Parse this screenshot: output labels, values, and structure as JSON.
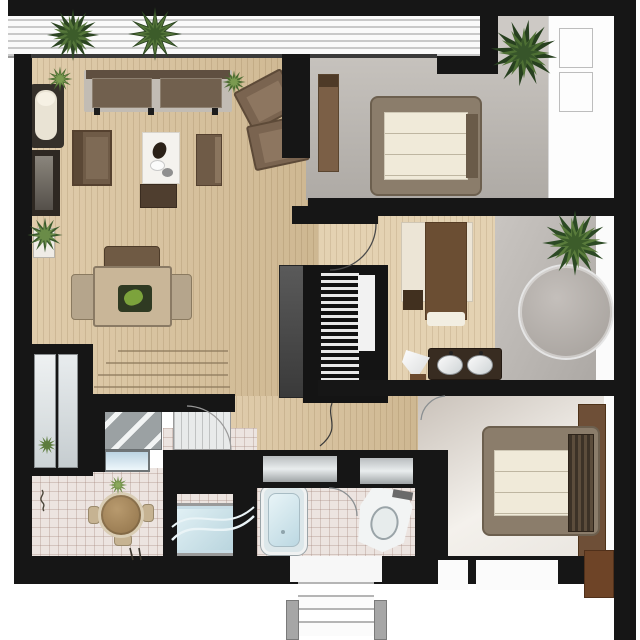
{
  "scene": {
    "type": "apartment floor plan, top-down rendered view",
    "text_labels": []
  },
  "palette": {
    "wall": "#161616",
    "wood_floor": "#d9c199",
    "wood_floor_light": "#e4d2b2",
    "gray_floor": "#b8b3ae",
    "tile_floor": "#ece4e0",
    "mattress": "#f0ead9",
    "bed_frame": "#8b7d6b",
    "sofa_brown": "#6f5b47",
    "dark_wood": "#6e4f37",
    "water_blue": "#cfe3ea",
    "plant_green": "#3c5c2a",
    "balcony_stripe": "#c9c9c9"
  },
  "rooms": [
    {
      "name": "balcony",
      "position": "top",
      "features": [
        "striped decking",
        "two hanging plants"
      ]
    },
    {
      "name": "living-dining-room",
      "floor": "wood planks",
      "furniture": [
        "two-seat sofa",
        "two angled wicker armchairs",
        "chaise lounge",
        "tv cabinet",
        "armchair",
        "white coffee table with decor pebbles",
        "ottoman",
        "side bench",
        "dining table with green centerpiece",
        "three dining chairs",
        "staircase steps",
        "black media wall unit with slatted shelf"
      ]
    },
    {
      "name": "bedroom-top-right",
      "floor": "gray",
      "furniture": [
        "double bed with cream mattress",
        "tall dresser",
        "white wardrobe with two door panels"
      ]
    },
    {
      "name": "middle-room",
      "floor": "light wood planks",
      "furniture": [
        "single bed with brown blanket and pillow",
        "dark bedside box"
      ]
    },
    {
      "name": "shower-room",
      "floor": "gray",
      "furniture": [
        "large round glass shower",
        "palm plant"
      ]
    },
    {
      "name": "vanity-area",
      "furniture": [
        "dark double-sink counter",
        "white cone basin"
      ]
    },
    {
      "name": "hallway",
      "floor": "pink tile",
      "furniture": [
        "round table with three stools",
        "frosted glass panel pair",
        "gray striped mat",
        "lined door panel"
      ]
    },
    {
      "name": "laundry",
      "floor": "tile",
      "furniture": [
        "washing machine",
        "bathtub with wavy water"
      ]
    },
    {
      "name": "bathroom",
      "floor": "tile",
      "furniture": [
        "vertical bathtub",
        "toilet",
        "door swing arc"
      ]
    },
    {
      "name": "bedroom-bottom-right",
      "floor": "light gradient",
      "furniture": [
        "double bed with striped dark headboard",
        "brown side panel",
        "brown left cabinet strip"
      ]
    }
  ],
  "entry": {
    "steps": 4,
    "position": "bottom-center",
    "posts": 2
  },
  "windows": {
    "closet_door_panels": 2,
    "window_bars_gray": 2,
    "window_bar_blue": 1,
    "white_light_strips": 2
  },
  "plants": {
    "balcony_plants": 2,
    "top_right_palm": 1,
    "indoor_palm": 1,
    "potted_plant": 1,
    "small_sprigs": 2,
    "grass_tufts": 2
  }
}
